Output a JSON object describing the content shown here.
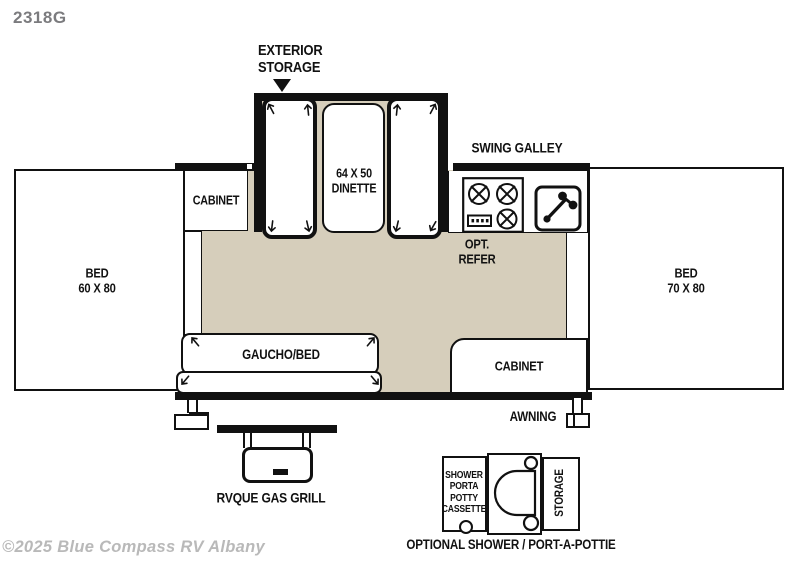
{
  "model": "2318G",
  "watermark": "©2025 Blue Compass RV Albany",
  "floorplan": {
    "exterior_storage": "EXTERIOR\nSTORAGE",
    "swing_galley": "SWING GALLEY",
    "dinette": "64 X 50\nDINETTE",
    "opt_refer": "OPT.\nREFER",
    "bed_left": "BED\n60 X 80",
    "bed_right": "BED\n70 X 80",
    "cabinet_top": "CABINET",
    "cabinet_bottom": "CABINET",
    "gaucho": "GAUCHO/BED",
    "awning": "AWNING",
    "grill": "RVQUE GAS GRILL",
    "optional_unit": {
      "shower": "SHOWER\nPORTA\nPOTTY\nCASSETTE",
      "storage": "STORAGE",
      "caption": "OPTIONAL SHOWER / PORT-A-POTTIE"
    }
  },
  "colors": {
    "floor": "#d6cebb",
    "line": "#111111",
    "model_text": "#7b7b7e",
    "watermark_text": "#b9b9b9"
  }
}
